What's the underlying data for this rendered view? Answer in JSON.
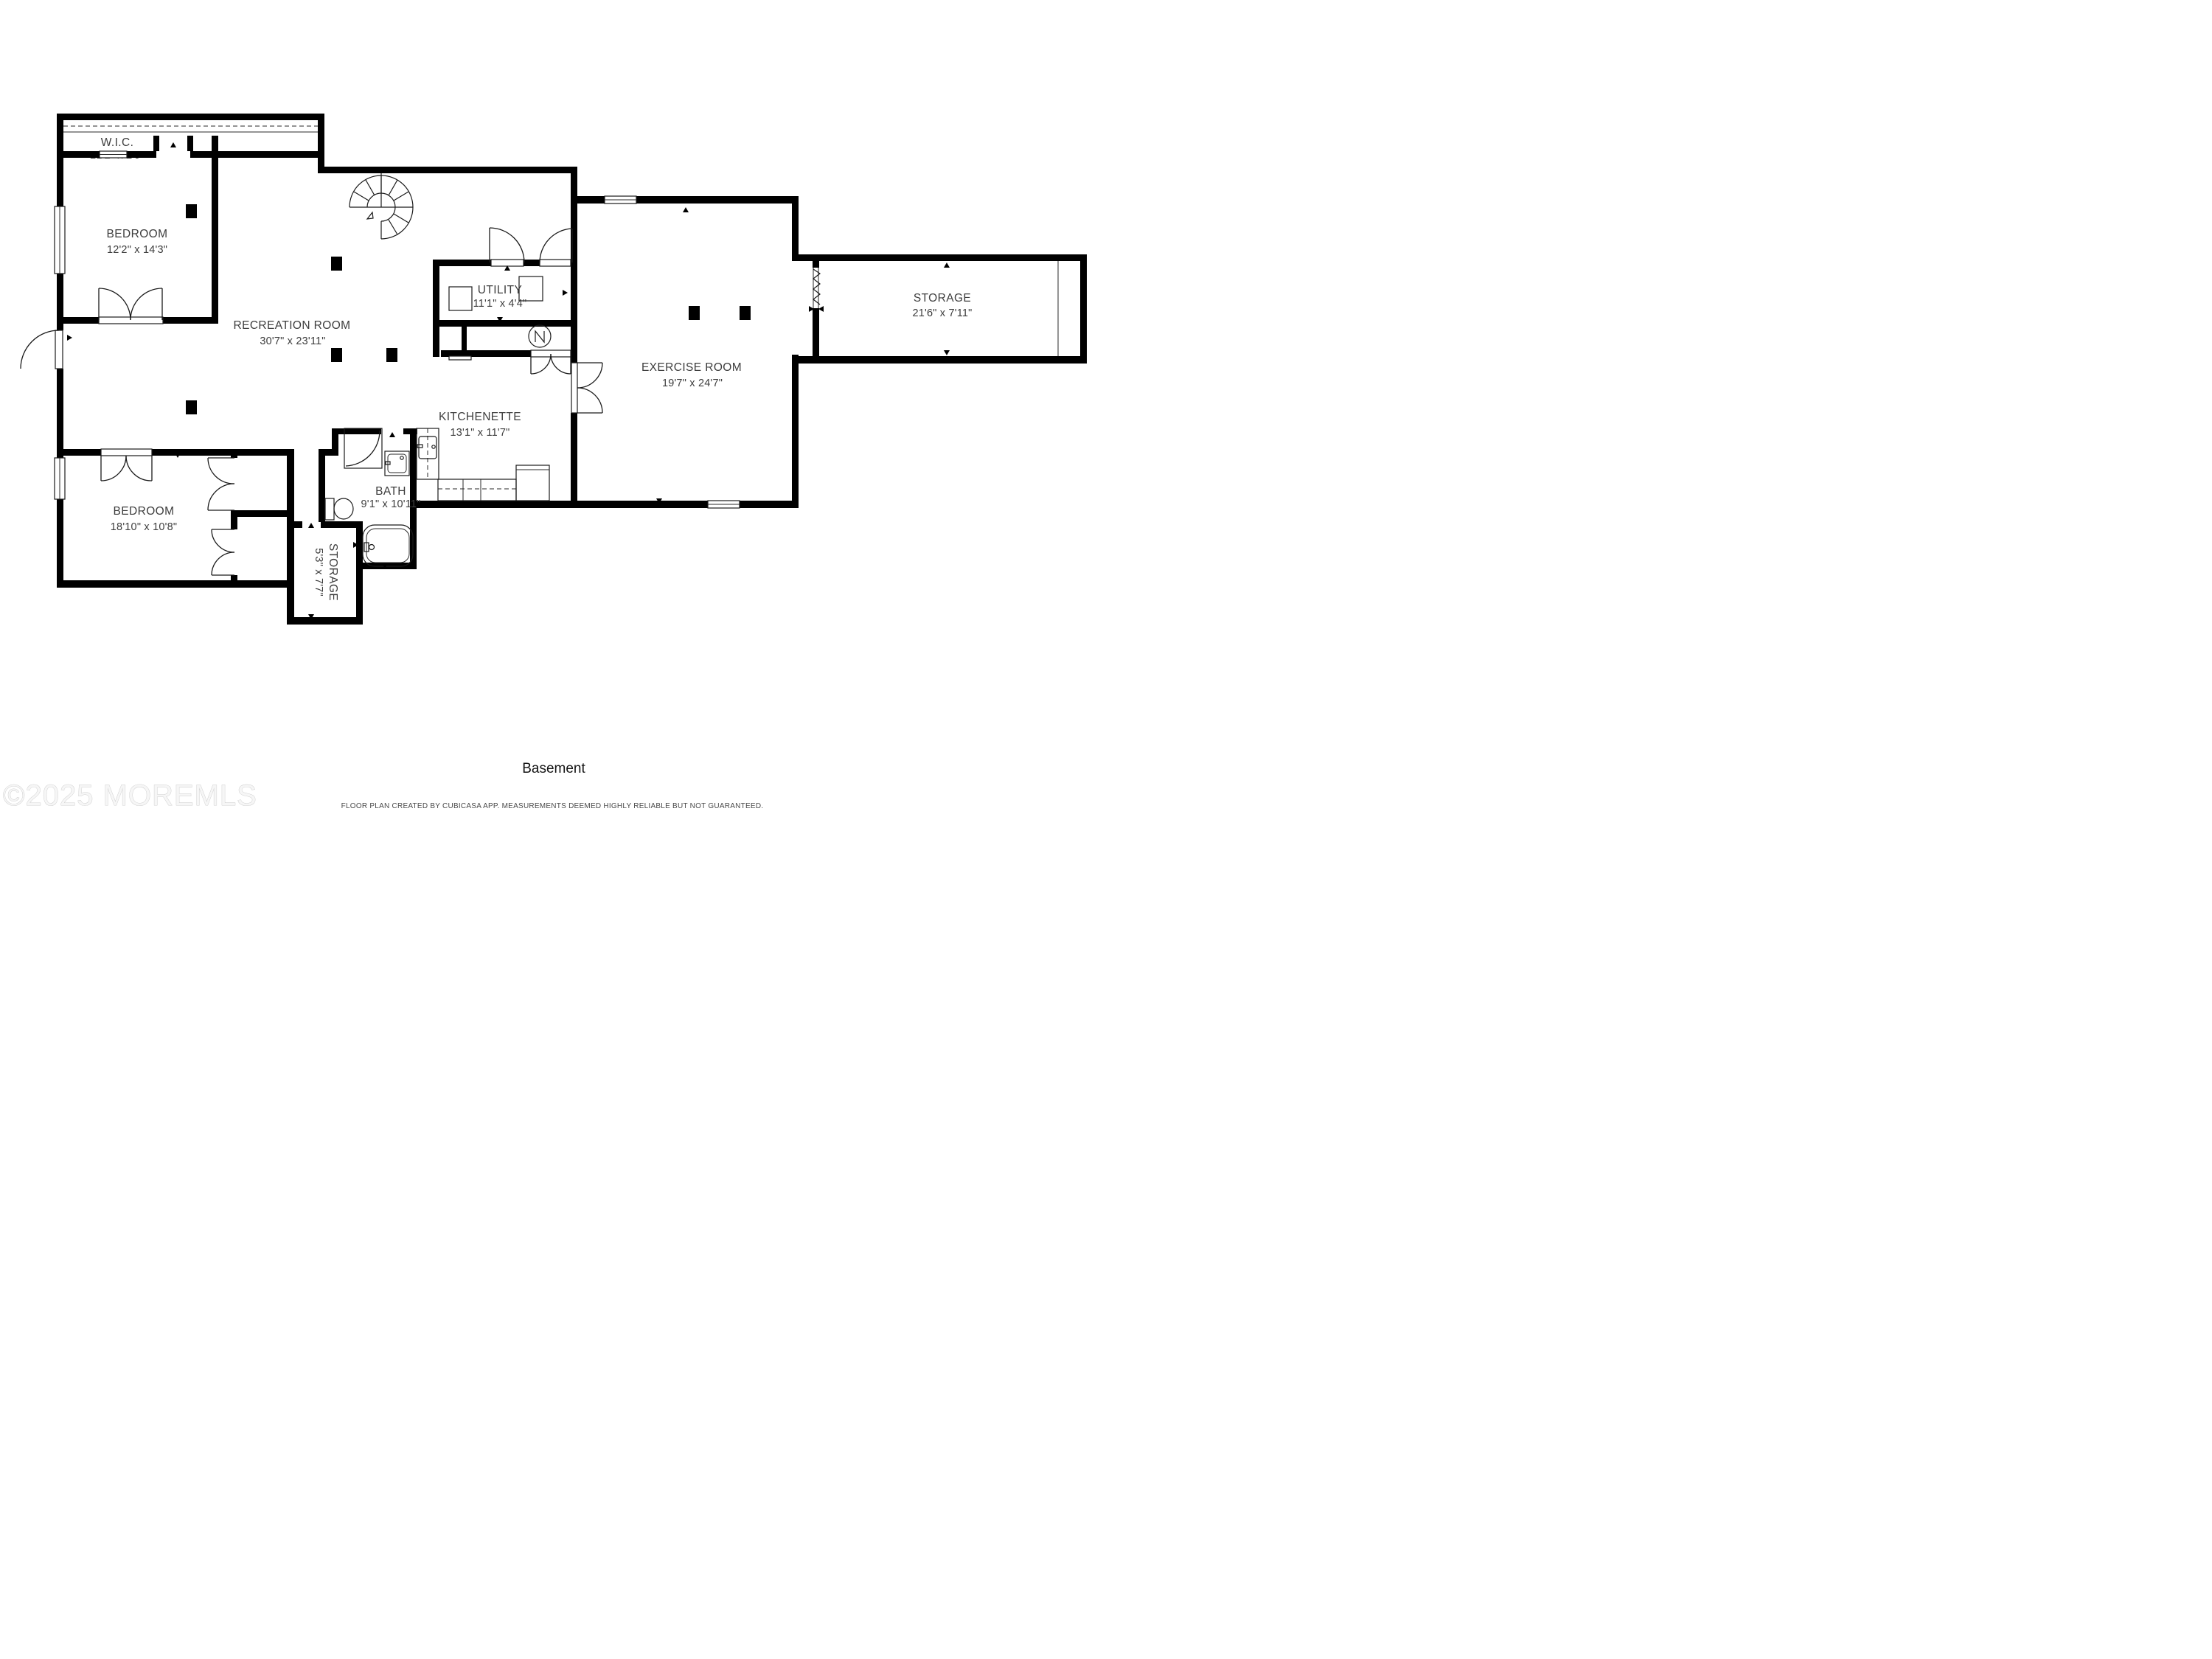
{
  "title": "Basement",
  "footer": "FLOOR PLAN CREATED BY CUBICASA APP. MEASUREMENTS DEEMED HIGHLY RELIABLE BUT NOT GUARANTEED.",
  "watermark": "©2025 MOREMLS",
  "colors": {
    "wall": "#000000",
    "label": "#3d3d3d",
    "watermark": "#ededed",
    "footer": "#4a4a4a"
  },
  "rooms": {
    "wic": {
      "name": "W.I.C.",
      "dims": "21'2\" x 2'9\""
    },
    "bedroom1": {
      "name": "BEDROOM",
      "dims": "12'2\" x 14'3\""
    },
    "recreation": {
      "name": "RECREATION ROOM",
      "dims": "30'7\" x 23'11\""
    },
    "utility": {
      "name": "UTILITY",
      "dims": "11'1\" x 4'4\""
    },
    "kitchenette": {
      "name": "KITCHENETTE",
      "dims": "13'1\" x 11'7\""
    },
    "bath": {
      "name": "BATH",
      "dims": "9'1\" x 10'11\""
    },
    "storage_small": {
      "name": "STORAGE",
      "dims": "5'3\" x 7'7\""
    },
    "bedroom2": {
      "name": "BEDROOM",
      "dims": "18'10\" x 10'8\""
    },
    "exercise": {
      "name": "EXERCISE ROOM",
      "dims": "19'7\" x 24'7\""
    },
    "storage_right": {
      "name": "STORAGE",
      "dims": "21'6\" x 7'11\""
    }
  }
}
